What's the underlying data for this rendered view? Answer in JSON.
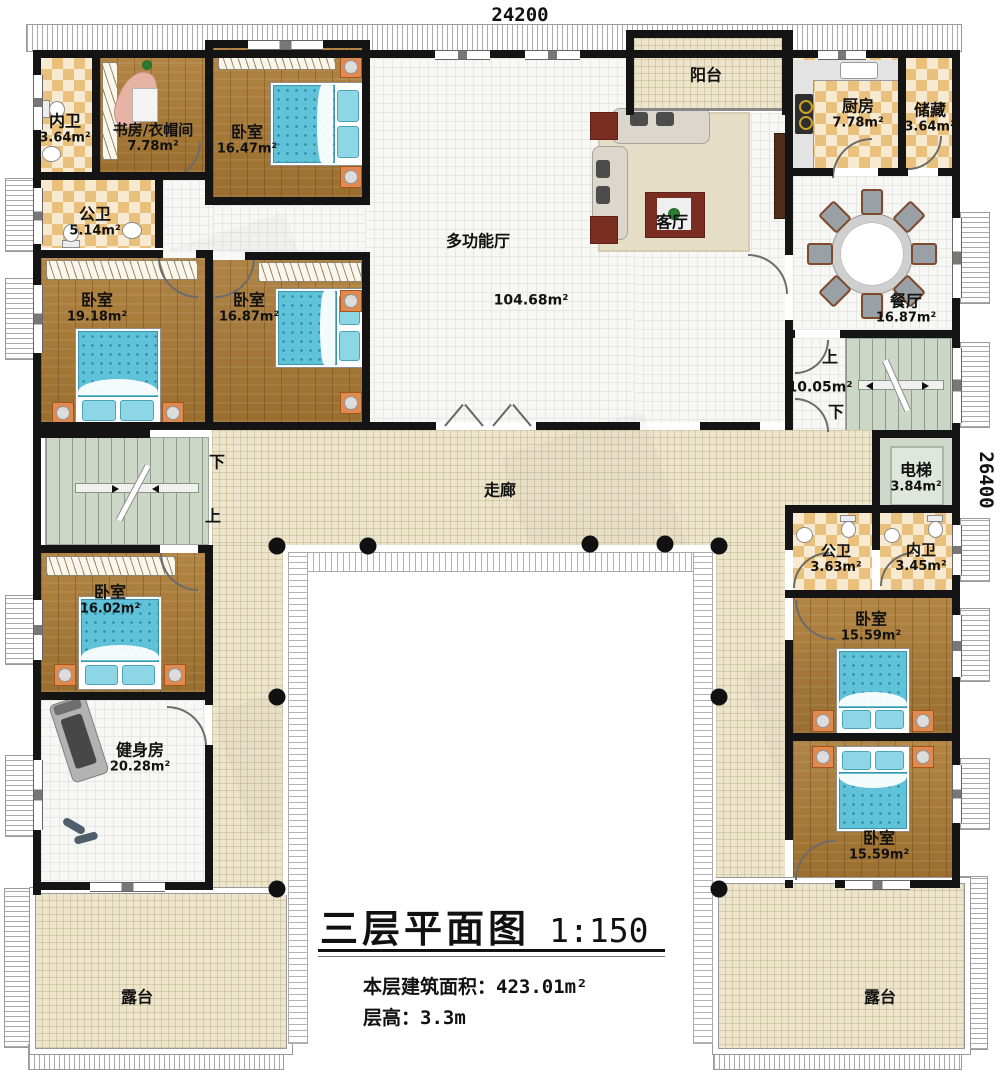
{
  "title_block": {
    "title": "三层平面图",
    "scale": "1:150",
    "area_label": "本层建筑面积：",
    "area_value": "423.01m²",
    "height_label": "层高：",
    "height_value": "3.3m"
  },
  "dimensions": {
    "top": "24200",
    "right": "26400"
  },
  "stairs": {
    "right_up": "上",
    "right_area": "10.05m²",
    "right_down": "下",
    "left_down": "下",
    "left_up": "上"
  },
  "rooms": [
    {
      "name": "内卫",
      "area": "3.64m²"
    },
    {
      "name": "书房/衣帽间",
      "area": "7.78m²"
    },
    {
      "name": "卧室",
      "area": "16.47m²"
    },
    {
      "name": "公卫",
      "area": "5.14m²"
    },
    {
      "name": "阳台",
      "area": ""
    },
    {
      "name": "厨房",
      "area": "7.78m²"
    },
    {
      "name": "储藏",
      "area": "3.64m²"
    },
    {
      "name": "多功能厅",
      "area": "104.68m²"
    },
    {
      "name": "客厅",
      "area": ""
    },
    {
      "name": "餐厅",
      "area": "16.87m²"
    },
    {
      "name": "卧室",
      "area": "19.18m²"
    },
    {
      "name": "卧室",
      "area": "16.87m²"
    },
    {
      "name": "走廊",
      "area": ""
    },
    {
      "name": "电梯",
      "area": "3.84m²"
    },
    {
      "name": "公卫",
      "area": "3.63m²"
    },
    {
      "name": "内卫",
      "area": "3.45m²"
    },
    {
      "name": "卧室",
      "area": "15.59m²"
    },
    {
      "name": "卧室",
      "area": "15.59m²"
    },
    {
      "name": "卧室",
      "area": "16.02m²"
    },
    {
      "name": "健身房",
      "area": "20.28m²"
    },
    {
      "name": "露台",
      "area": ""
    },
    {
      "name": "露台",
      "area": ""
    }
  ]
}
